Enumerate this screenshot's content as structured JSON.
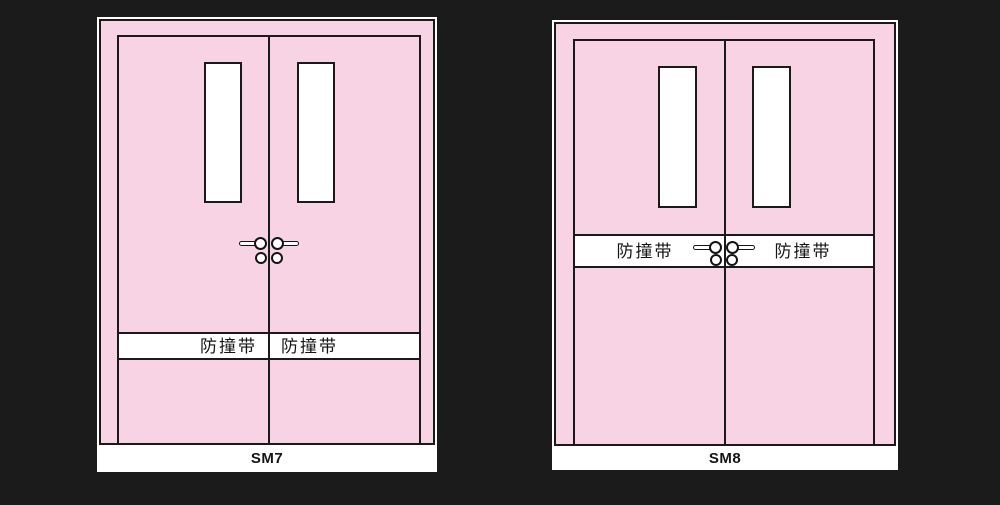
{
  "scene": {
    "background_color": "#1b1b1b",
    "door_fill_color": "#f8d3e3",
    "outline_color": "#1a1a1a"
  },
  "doors": [
    {
      "label": "SM7",
      "bumper_band": {
        "left_text": "防撞带",
        "right_text": "防撞带"
      }
    },
    {
      "label": "SM8",
      "bumper_band": {
        "left_text": "防撞带",
        "right_text": "防撞带"
      }
    }
  ]
}
